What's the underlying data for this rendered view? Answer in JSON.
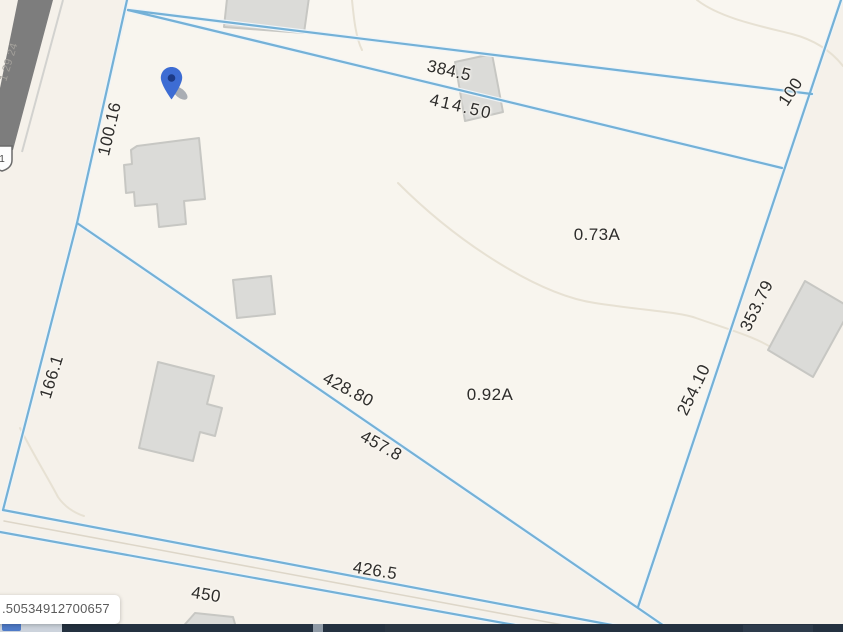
{
  "map": {
    "type": "parcel-boundary-map",
    "dimensions": {
      "top_upper": "384.5",
      "top_lower": "414.50",
      "left_upper": "100.16",
      "left_lower": "166.1",
      "right_upper": "100",
      "right_mid": "353.79",
      "right_lower": "254.10",
      "mid_upper": "428.80",
      "mid_lower": "457.8",
      "bottom_road_upper": "426.5",
      "bottom_road_lower": "450"
    },
    "areas": {
      "north_parcel": "0.73A",
      "south_parcel": "0.92A"
    },
    "road": {
      "shield": "1",
      "name_label": "1 29 24"
    },
    "tooltip": {
      "parcel_id": ".50534912700657"
    },
    "colors": {
      "map_bg": "#f5f1ea",
      "parcel_fill": "#f9f6f0",
      "parcel_line": "#74b1d7",
      "building_fill": "#dbdbd8",
      "building_stroke": "#c7c7c3",
      "road_fill": "#7d7d7d",
      "pin_blue": "#3d6cd3",
      "bottom_bar": "#243140",
      "attribution_chip": "#4f7bc8"
    }
  }
}
